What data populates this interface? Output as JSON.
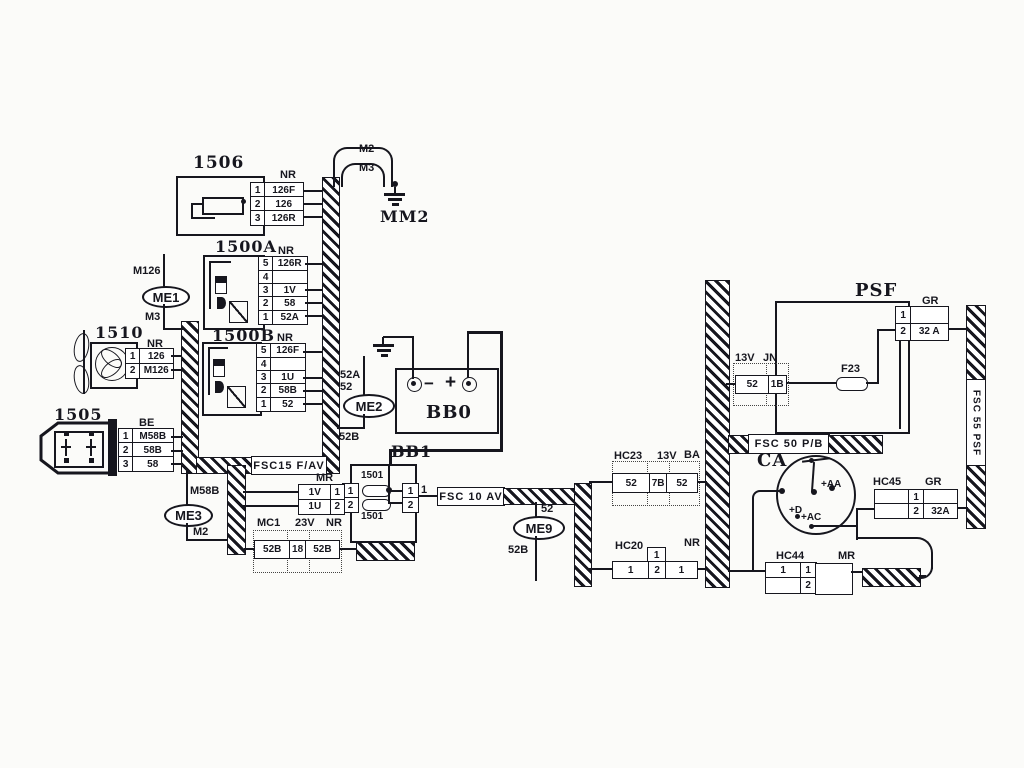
{
  "c1506": {
    "title": "1506",
    "conn": "NR",
    "rows": [
      {
        "pin": "1",
        "wire": "126F"
      },
      {
        "pin": "2",
        "wire": "126"
      },
      {
        "pin": "3",
        "wire": "126R"
      }
    ]
  },
  "c1500A": {
    "title": "1500A",
    "conn": "NR",
    "rows": [
      {
        "pin": "5",
        "wire": "126R"
      },
      {
        "pin": "4",
        "wire": ""
      },
      {
        "pin": "3",
        "wire": "1V"
      },
      {
        "pin": "2",
        "wire": "58"
      },
      {
        "pin": "1",
        "wire": "52A"
      }
    ]
  },
  "c1500B": {
    "title": "1500B",
    "conn": "NR",
    "rows": [
      {
        "pin": "5",
        "wire": "126F"
      },
      {
        "pin": "4",
        "wire": ""
      },
      {
        "pin": "3",
        "wire": "1U"
      },
      {
        "pin": "2",
        "wire": "58B"
      },
      {
        "pin": "1",
        "wire": "52"
      }
    ]
  },
  "c1510": {
    "title": "1510",
    "conn": "NR",
    "rows": [
      {
        "pin": "1",
        "wire": "126"
      },
      {
        "pin": "2",
        "wire": "M126"
      }
    ]
  },
  "c1505": {
    "title": "1505",
    "conn": "BE",
    "rows": [
      {
        "pin": "1",
        "wire": "M58B"
      },
      {
        "pin": "2",
        "wire": "58B"
      },
      {
        "pin": "3",
        "wire": "58"
      }
    ]
  },
  "mm2": {
    "label": "MM2",
    "wire_top": "M2",
    "wire_bottom": "M3"
  },
  "me1": {
    "label": "ME1",
    "above": "M126",
    "below": "M3"
  },
  "me2": {
    "label": "ME2",
    "above1": "52A",
    "above2": "52",
    "below": "52B"
  },
  "me3": {
    "label": "ME3",
    "above": "M58B",
    "below": "M2"
  },
  "me9": {
    "label": "ME9",
    "above": "52",
    "below": "52B"
  },
  "bb0": {
    "title": "BB0",
    "minus": "−",
    "plus": "+"
  },
  "bb1": {
    "title": "BB1",
    "fuse_top": "1501",
    "fuse_bottom": "1501",
    "pins_left": [
      "1",
      "2"
    ],
    "pins_right": [
      "1",
      "2"
    ],
    "out_wire": "1"
  },
  "mr": {
    "conn": "MR",
    "rows": [
      {
        "wire": "1V",
        "pin": "1"
      },
      {
        "wire": "1U",
        "pin": "2"
      }
    ]
  },
  "mc1": {
    "name": "MC1",
    "code": "23V",
    "conn": "NR",
    "cells": [
      "52B",
      "18",
      "52B"
    ]
  },
  "hc23": {
    "name": "HC23",
    "code": "13V",
    "conn": "BA",
    "cells": [
      "52",
      "7B",
      "52"
    ]
  },
  "jn": {
    "code": "13V",
    "conn": "JN",
    "cells": [
      "52",
      "1B"
    ]
  },
  "hc20": {
    "name": "HC20",
    "conn": "NR",
    "pin_top": "1",
    "cells": [
      "1",
      "2",
      "1"
    ]
  },
  "hc44": {
    "name": "HC44",
    "conn": "MR",
    "wires_left": [
      "1",
      ""
    ],
    "pins": [
      "1",
      "2"
    ]
  },
  "hc45": {
    "name": "HC45",
    "conn": "GR",
    "pins": [
      "1",
      "2"
    ],
    "wires_right": [
      "",
      "32A"
    ]
  },
  "psf": {
    "title": "PSF",
    "conn": "GR",
    "pins": [
      "1",
      "2"
    ],
    "wires_right": [
      "",
      "32 A"
    ],
    "fuse": "F23"
  },
  "ca": {
    "title": "CA",
    "terminals": {
      "aa": "+AA",
      "d": "+D",
      "ac": "+AC"
    }
  },
  "fsc": {
    "fsc15": "FSC15 F/AV",
    "fsc10": "FSC 10 AV",
    "fsc50": "FSC 50 P/B",
    "fsc55": "FSC 55 PSF"
  }
}
